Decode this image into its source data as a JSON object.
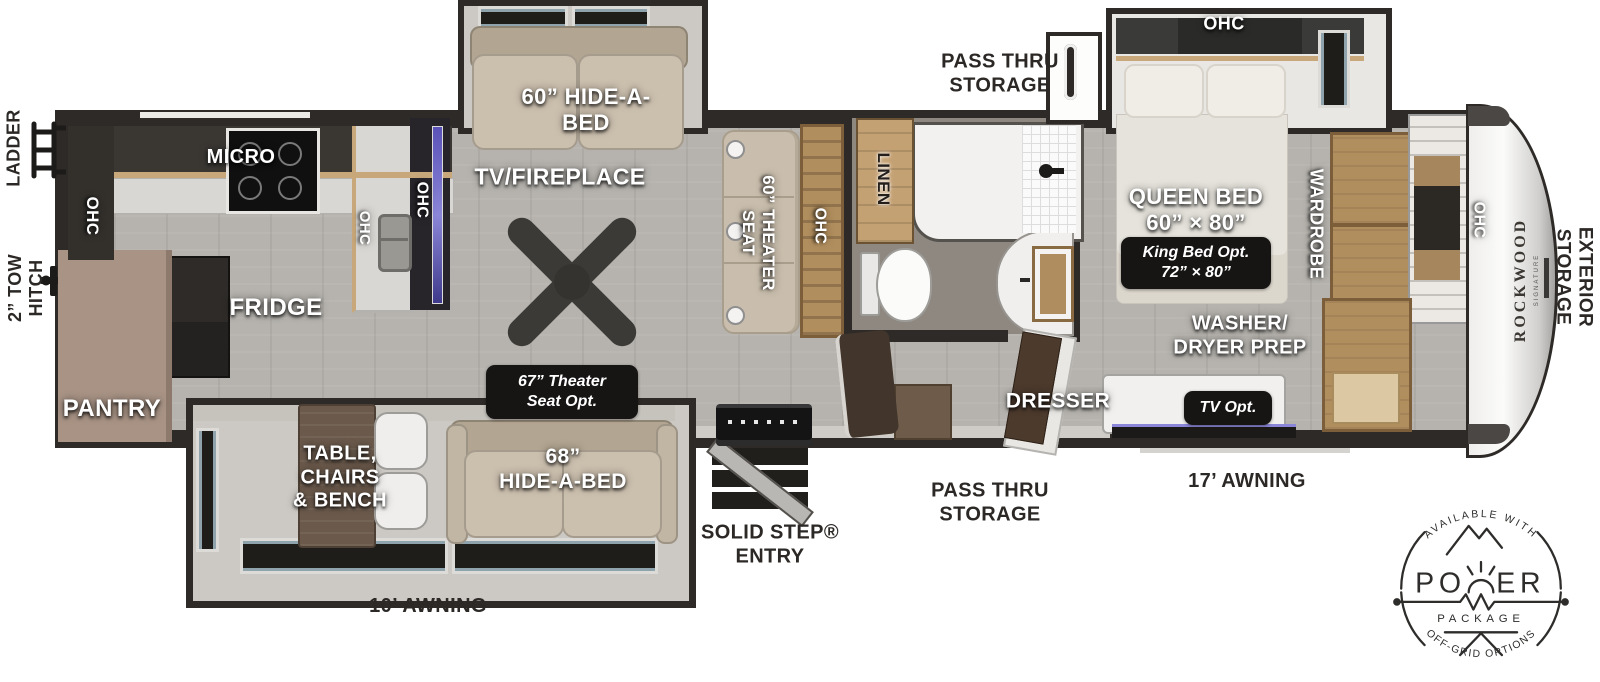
{
  "labels": {
    "ladder": "LADDER",
    "tow_hitch": "2” TOW\nHITCH",
    "micro": "MICRO",
    "ohc": "OHC",
    "fridge": "FRIDGE",
    "pantry": "PANTRY",
    "tv_fireplace": "TV/FIREPLACE",
    "hide_a_bed_60": "60” HIDE-A-\nBED",
    "theater_seat_60": "60” THEATER\nSEAT",
    "linen": "LINEN",
    "pass_thru_top": "PASS THRU\nSTORAGE",
    "pass_thru_bottom": "PASS THRU\nSTORAGE",
    "queen_bed": "QUEEN BED\n60” × 80”",
    "king_bed_opt": "King Bed Opt.\n72” × 80”",
    "wardrobe": "WARDROBE",
    "washer_dryer": "WASHER/\nDRYER PREP",
    "dresser": "DRESSER",
    "tv_opt": "TV Opt.",
    "exterior_storage": "EXTERIOR\nSTORAGE",
    "brand": "ROCKWOOD",
    "brand_sub": "SIGNATURE",
    "table_chairs": "TABLE,\nCHAIRS\n& BENCH",
    "hide_a_bed_68": "68”\nHIDE-A-BED",
    "theater_opt_67": "67” Theater\nSeat Opt.",
    "awning_10": "10’ AWNING",
    "awning_17": "17’ AWNING",
    "solid_step": "SOLID STEP®\nENTRY"
  },
  "power_badge": {
    "available": "AVAILABLE WITH",
    "power_left": "PO",
    "power_right": "ER",
    "package": "PACKAGE",
    "offgrid": "OFF-GRID OPTIONS"
  },
  "colors": {
    "wall": "#2d2a27",
    "floor": "#b6b3ae",
    "slide_floor": "#86776a",
    "sofa": "#cbbfae",
    "cabinet_wood": "#b18e5e",
    "badge_bg": "#161514",
    "tv_glow": "#8b86d8"
  }
}
